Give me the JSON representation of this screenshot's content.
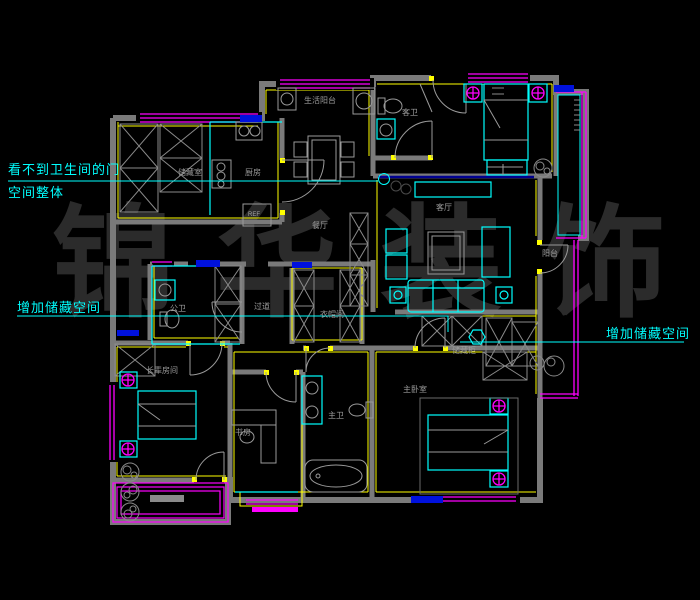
{
  "meta": {
    "type": "cad-floorplan-screenshot"
  },
  "watermark": {
    "text": "锦华装饰",
    "chars": [
      "锦",
      "华",
      "装",
      "饰"
    ],
    "color": "#2b2b2b"
  },
  "annotations": {
    "bathroom_door": {
      "line1": "看不到卫生间的门",
      "line2": "空间整体"
    },
    "add_storage_left": {
      "text": "增加储藏空间"
    },
    "add_storage_right": {
      "text": "增加储藏空间"
    }
  },
  "rooms": {
    "laundry_balcony": "生活阳台",
    "storage_room": "储藏室",
    "kitchen": "厨房",
    "guest_bath": "客卫",
    "dining": "餐厅",
    "living": "客厅",
    "balcony_right": "阳台",
    "public_bath": "公卫",
    "hallway": "过道",
    "cloakroom": "衣帽间",
    "storage_cabinet": "储藏柜",
    "elders_room": "长辈房间",
    "study": "书房",
    "master_bath": "主卫",
    "master_bedroom": "主卧室"
  },
  "fixtures": {
    "refrigerator": "REF"
  },
  "colors": {
    "background": "#000000",
    "walls": "#7a7a7a",
    "windows": "#ff00ff",
    "wall_lines": "#ffff00",
    "furniture": "#00ffff",
    "accents": "#0000cc",
    "labels": "#9b9b9b",
    "annotations": "#00ffff",
    "watermark": "#2b2b2b"
  }
}
